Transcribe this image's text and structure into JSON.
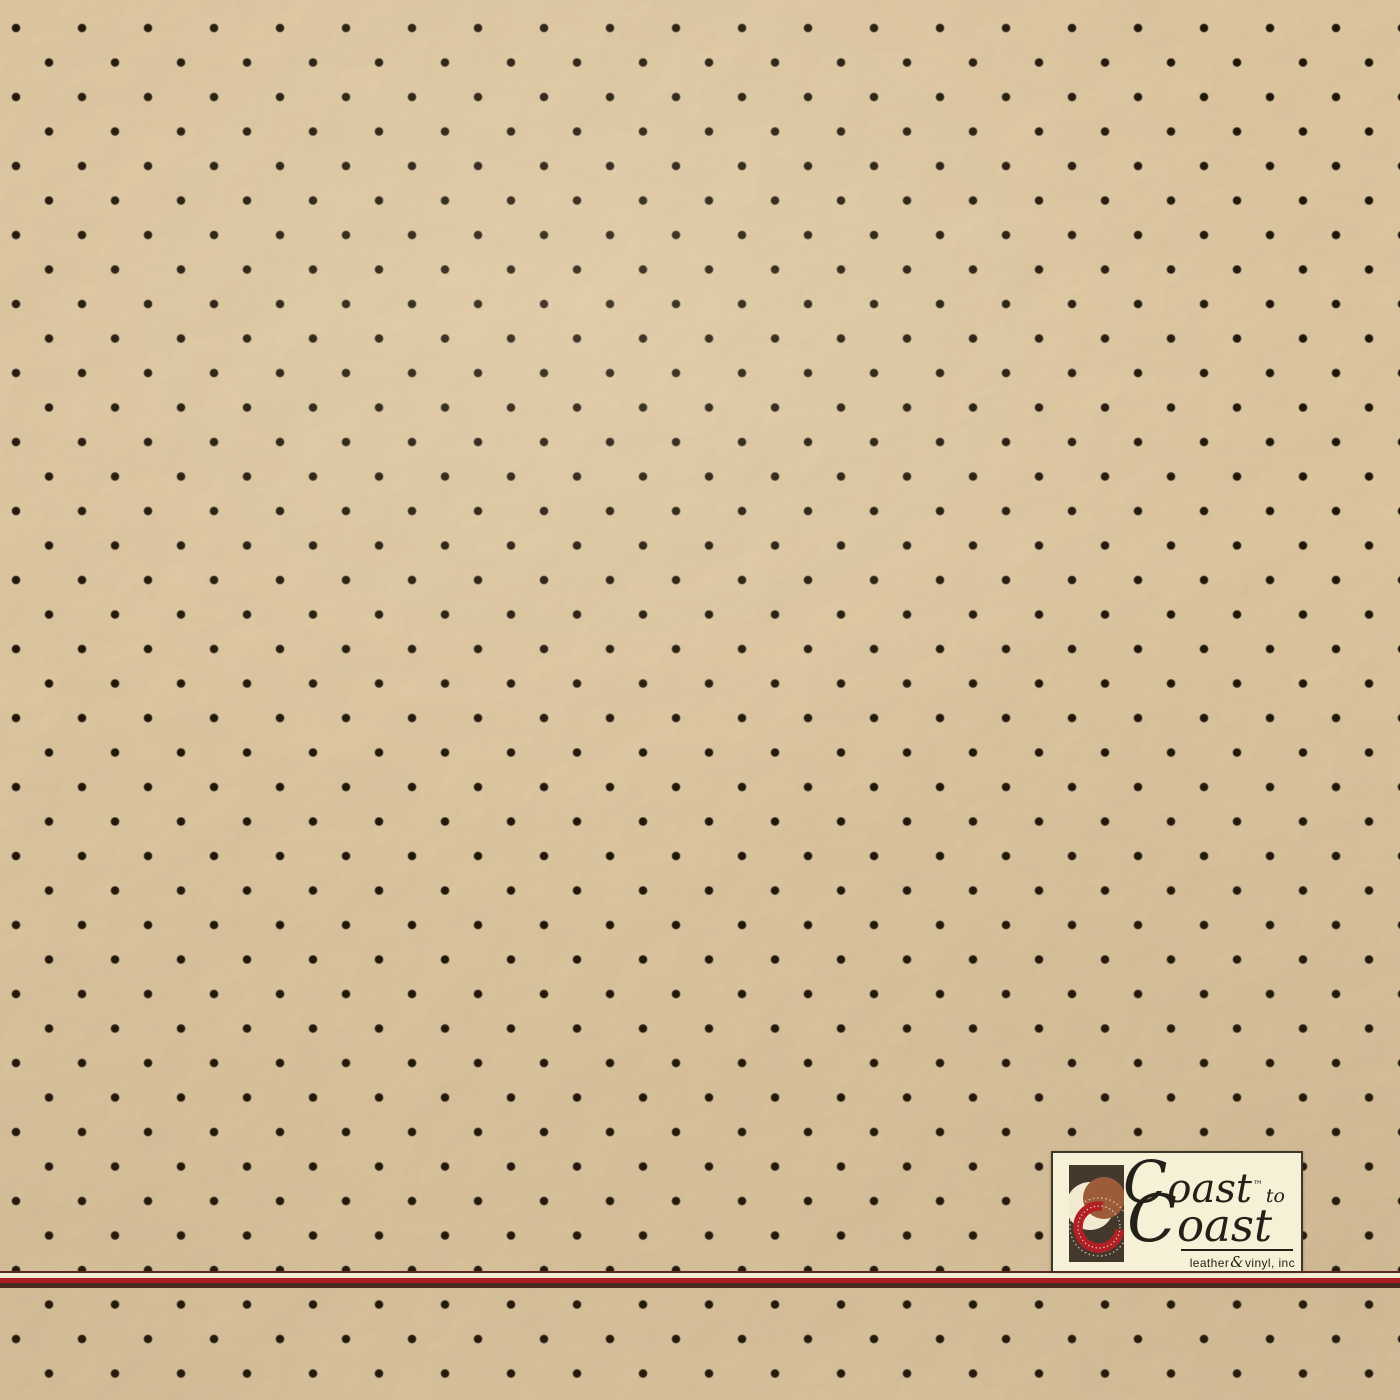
{
  "photo": {
    "subject": "Beige perforated leather/vinyl upholstery swatch with pebbled grain",
    "perforation": {
      "pitch_x_px": 66,
      "pitch_y_px": 34.5,
      "row_offset_px": 33,
      "dot_diameter_px": 9
    }
  },
  "logo": {
    "line1": "Coast",
    "trademark": "™",
    "connector": "to",
    "line2": "Coast",
    "tagline_left": "leather",
    "tagline_amp": "&",
    "tagline_right": "vinyl, inc"
  },
  "colors": {
    "leather_base": "#e0c9a2",
    "perf_dot": "#211709",
    "stripe_line": "#5a2721",
    "stripe_cream": "#f2ecd2",
    "stripe_red": "#a81e22",
    "stripe_dark": "#462a1d",
    "plaque_bg": "#f6f0d6",
    "plaque_border": "#3f362b",
    "logo_ink": "#23201a",
    "mark_bg": "#44372c",
    "mark_cream": "#f2ead0",
    "mark_sienna": "#9d5c39",
    "mark_red": "#b02025"
  }
}
